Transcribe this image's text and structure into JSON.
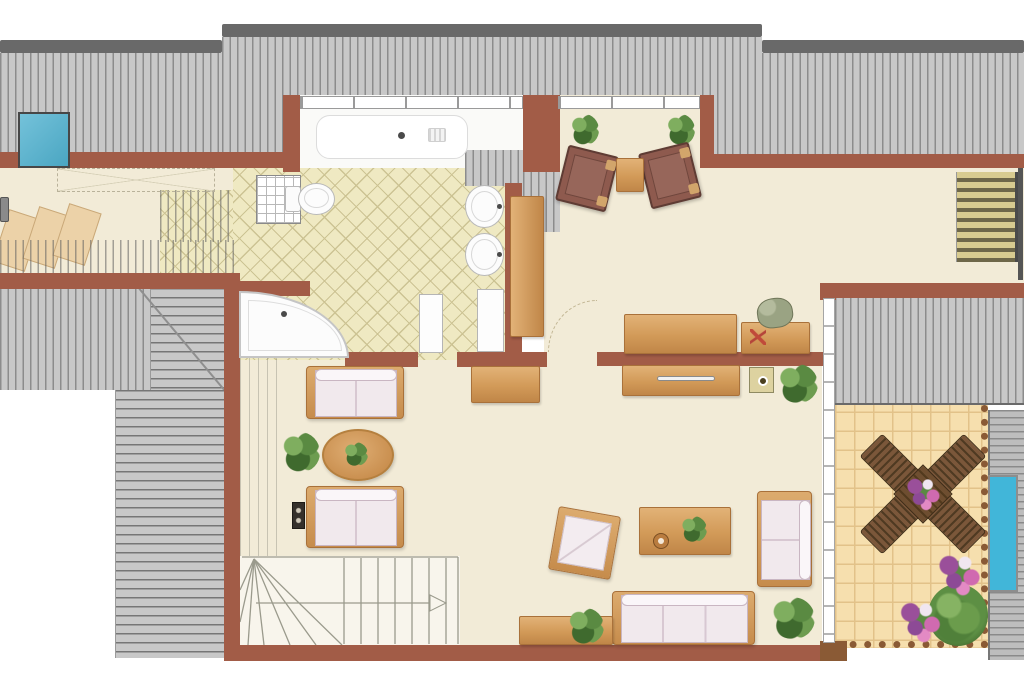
{
  "document": {
    "kind": "floor-plan",
    "floor": "attic",
    "canvas": {
      "width": 1024,
      "height": 683
    }
  },
  "palette": {
    "wall": "#a25c47",
    "fence": "#8a5a35",
    "floor": "#f2ebd7",
    "floor_white": "#fafaf8",
    "hatch_bg": "#c8c8c8",
    "hatch_line": "#8c8c8c",
    "cap": "#696969",
    "tile_bath": "#efe9c2",
    "tile_bath_line": "#ccc393",
    "tile_terrace": "#f6dfae",
    "tile_terrace_line": "#e2c289",
    "wood_hi": "#e2b277",
    "wood_lo": "#c08648",
    "wood_edge": "#a9713a",
    "sofa_fill": "#f1e9ed",
    "sofa_edge": "#c9b6c2",
    "chair_brown": "#8e5a4e",
    "chair_brown_edge": "#5f3c34",
    "pad": "#d2a56b",
    "plant_dark": "#3f6a2e",
    "plant_mid": "#5a8a42",
    "plant_light": "#7fae5f",
    "flower_purple": "#9a4f9a",
    "flower_pink": "#d06ab0",
    "sky_blue": "#4aa6c2",
    "pool_blue": "#41b6d9",
    "stripe_light": "#d8cb90",
    "stripe_dark": "#6e6749",
    "fixture": "#fcfcfc",
    "fixture_edge": "#c2c2c2",
    "stair_line": "#9a9a8c",
    "deck_bg": "#bdbdbd",
    "deck_line": "#8a8a8a",
    "arc": "#c2b694",
    "red_mark": "#c04a3a",
    "pig": "#9aa383",
    "pig_edge": "#6f7558",
    "dark": "#35302b"
  },
  "items": [
    {
      "name": "roof-cap-left",
      "type": "cap",
      "rect": [
        0,
        40,
        222,
        13
      ]
    },
    {
      "name": "roof-cap-middle",
      "type": "cap",
      "rect": [
        222,
        24,
        540,
        13
      ]
    },
    {
      "name": "roof-cap-right",
      "type": "cap",
      "rect": [
        762,
        40,
        262,
        13
      ]
    },
    {
      "name": "roof-slope-top-left",
      "type": "hatchv",
      "rect": [
        0,
        53,
        222,
        115
      ]
    },
    {
      "name": "roof-slope-top-middle",
      "type": "hatchv",
      "rect": [
        222,
        37,
        540,
        131
      ]
    },
    {
      "name": "roof-slope-top-right",
      "type": "hatchv",
      "rect": [
        762,
        53,
        262,
        101
      ]
    },
    {
      "name": "hallway-floor",
      "type": "floor",
      "rect": [
        0,
        168,
        160,
        105
      ]
    },
    {
      "name": "hallway-floor-sliver",
      "type": "floor",
      "rect": [
        160,
        168,
        123,
        24
      ]
    },
    {
      "name": "bathroom-dormer-floor",
      "type": "floorwhite",
      "rect": [
        300,
        95,
        223,
        77
      ]
    },
    {
      "name": "sitting-room-floor",
      "type": "floor",
      "rect": [
        558,
        95,
        144,
        75
      ]
    },
    {
      "name": "hall-floor",
      "type": "floor",
      "rect": [
        544,
        168,
        291,
        192
      ]
    },
    {
      "name": "corridor-floor",
      "type": "floor",
      "rect": [
        835,
        168,
        189,
        115
      ]
    },
    {
      "name": "living-room-floor",
      "type": "floor",
      "rect": [
        240,
        356,
        582,
        289
      ]
    },
    {
      "name": "bathroom-tiles",
      "type": "tilesbath",
      "rect": [
        233,
        168,
        289,
        192
      ]
    },
    {
      "name": "bathroom-tiles-strip",
      "type": "tilesbath",
      "rect": [
        160,
        190,
        73,
        83
      ]
    },
    {
      "name": "wood-step-1",
      "type": "stepwood",
      "rect": [
        0,
        213,
        34,
        55
      ],
      "rot": 18
    },
    {
      "name": "wood-step-2",
      "type": "stepwood",
      "rect": [
        30,
        210,
        34,
        55
      ],
      "rot": 18
    },
    {
      "name": "wood-step-3",
      "type": "stepwood",
      "rect": [
        60,
        207,
        34,
        55
      ],
      "rot": 18
    },
    {
      "name": "roof-overlay-hallway",
      "type": "vlines",
      "rect": [
        0,
        240,
        237,
        33
      ]
    },
    {
      "name": "roof-overlay-tiles",
      "type": "vlines",
      "rect": [
        160,
        190,
        73,
        52
      ]
    },
    {
      "name": "knee-wall-strip",
      "type": "vlineslight",
      "rect": [
        240,
        358,
        38,
        198
      ]
    },
    {
      "name": "roof-slope-left-mid",
      "type": "hatchv",
      "rect": [
        0,
        288,
        225,
        102
      ]
    },
    {
      "name": "roof-slope-left-hip",
      "type": "hatchh",
      "rect": [
        150,
        288,
        75,
        102
      ]
    },
    {
      "name": "roof-hip-line",
      "type": "hipline",
      "rect": [
        140,
        288,
        133,
        2
      ],
      "rot": 50
    },
    {
      "name": "roof-slope-bottom-left",
      "type": "hatchh",
      "rect": [
        115,
        390,
        110,
        268
      ]
    },
    {
      "name": "roof-patch-bath-ne",
      "type": "hatchv",
      "rect": [
        465,
        150,
        47,
        36
      ]
    },
    {
      "name": "roof-patch-wardrobe",
      "type": "hatchv",
      "rect": [
        510,
        150,
        50,
        46
      ]
    },
    {
      "name": "roof-patch-hall-west",
      "type": "hatchv",
      "rect": [
        523,
        170,
        37,
        62
      ]
    },
    {
      "name": "terrace-tiles",
      "type": "tilesterr",
      "rect": [
        835,
        405,
        153,
        243
      ]
    },
    {
      "name": "terrace-decking",
      "type": "deck",
      "rect": [
        988,
        410,
        36,
        250
      ]
    },
    {
      "name": "roof-slope-right-mid",
      "type": "hatchv edgeb",
      "rect": [
        835,
        298,
        189,
        107
      ]
    },
    {
      "name": "wall-hallway-north",
      "type": "wall",
      "rect": [
        0,
        152,
        300,
        16
      ]
    },
    {
      "name": "wall-bath-dormer-left",
      "type": "wall",
      "rect": [
        283,
        95,
        17,
        77
      ]
    },
    {
      "name": "wall-bath-sitting-divider",
      "type": "wall",
      "rect": [
        523,
        95,
        37,
        77
      ]
    },
    {
      "name": "wall-sitting-right",
      "type": "wall",
      "rect": [
        700,
        95,
        14,
        73
      ]
    },
    {
      "name": "wall-corridor-north",
      "type": "wall",
      "rect": [
        713,
        154,
        311,
        14
      ]
    },
    {
      "name": "wall-corridor-south",
      "type": "wall",
      "rect": [
        825,
        283,
        199,
        15
      ]
    },
    {
      "name": "wall-hallway-south",
      "type": "wall",
      "rect": [
        0,
        273,
        240,
        16
      ]
    },
    {
      "name": "wall-left-main",
      "type": "wall",
      "rect": [
        224,
        283,
        16,
        377
      ]
    },
    {
      "name": "wall-bath-nook",
      "type": "wall",
      "rect": [
        233,
        281,
        77,
        15
      ]
    },
    {
      "name": "wall-bath-south-west",
      "type": "wall",
      "rect": [
        345,
        352,
        73,
        15
      ]
    },
    {
      "name": "wall-bath-south-east",
      "type": "wall",
      "rect": [
        457,
        352,
        90,
        15
      ]
    },
    {
      "name": "wall-hall-south",
      "type": "wall",
      "rect": [
        597,
        352,
        233,
        14
      ]
    },
    {
      "name": "wall-bath-east",
      "type": "wall",
      "rect": [
        505,
        183,
        17,
        174
      ]
    },
    {
      "name": "wall-bottom",
      "type": "wall",
      "rect": [
        224,
        645,
        623,
        16
      ]
    },
    {
      "name": "wall-terrace-nw-post",
      "type": "wall",
      "rect": [
        820,
        283,
        16,
        17
      ]
    },
    {
      "name": "wall-terrace-sw-post",
      "type": "wallfence",
      "rect": [
        820,
        641,
        27,
        20
      ]
    },
    {
      "name": "bathroom-window",
      "type": "windowband",
      "rect": [
        300,
        96,
        223,
        13
      ]
    },
    {
      "name": "sitting-room-window",
      "type": "windowband",
      "rect": [
        558,
        96,
        142,
        13
      ]
    },
    {
      "name": "terrace-glass-wall",
      "type": "glassv",
      "rect": [
        823,
        298,
        12,
        345
      ]
    },
    {
      "name": "skylight",
      "type": "skylight",
      "rect": [
        18,
        112,
        52,
        56
      ]
    },
    {
      "name": "terrace-planter",
      "type": "planter",
      "rect": [
        988,
        475,
        30,
        117
      ]
    },
    {
      "name": "stairs-down",
      "type": "stripstairs",
      "rect": [
        956,
        172,
        62,
        90
      ]
    },
    {
      "name": "corridor-end-window",
      "type": "darkedge",
      "rect": [
        1018,
        168,
        5,
        112
      ]
    },
    {
      "name": "low-headroom-zone",
      "type": "dashrect",
      "rect": [
        57,
        168,
        158,
        24
      ]
    },
    {
      "name": "hallway-door-pull",
      "type": "graypull",
      "rect": [
        0,
        197,
        9,
        25
      ]
    },
    {
      "name": "bathtub",
      "type": "tub",
      "rect": [
        302,
        108,
        198,
        62
      ]
    },
    {
      "name": "shower",
      "type": "shower",
      "rect": [
        256,
        175,
        45,
        49
      ]
    },
    {
      "name": "toilet",
      "type": "toilet",
      "rect": [
        285,
        183,
        50,
        32
      ]
    },
    {
      "name": "washbasin-1",
      "type": "sink",
      "rect": [
        465,
        185,
        39,
        43
      ]
    },
    {
      "name": "washbasin-2",
      "type": "sink",
      "rect": [
        465,
        233,
        39,
        43
      ]
    },
    {
      "name": "bathroom-cabinet",
      "type": "cabinet",
      "rect": [
        477,
        289,
        27,
        63
      ]
    },
    {
      "name": "bathroom-door-leaf",
      "type": "cabinet",
      "rect": [
        419,
        294,
        24,
        59
      ]
    },
    {
      "name": "corner-bathtub",
      "type": "cornertub",
      "rect": [
        239,
        291,
        110,
        67
      ]
    },
    {
      "name": "wardrobe",
      "type": "woodv",
      "rect": [
        510,
        196,
        34,
        141
      ]
    },
    {
      "name": "hall-sideboard",
      "type": "wood",
      "rect": [
        624,
        314,
        113,
        40
      ]
    },
    {
      "name": "hall-desk",
      "type": "wood",
      "rect": [
        741,
        322,
        69,
        32
      ]
    },
    {
      "name": "piggy-bank",
      "type": "pig",
      "rect": [
        757,
        298,
        36,
        30
      ],
      "rot": -8
    },
    {
      "name": "desk-marks",
      "type": "marksred",
      "rect": [
        750,
        329,
        16,
        16
      ]
    },
    {
      "name": "tv-lowboard",
      "type": "wood",
      "rect": [
        622,
        365,
        118,
        31
      ]
    },
    {
      "name": "lowboard-handle",
      "type": "handle",
      "rect": [
        657,
        376,
        58,
        5
      ]
    },
    {
      "name": "wall-stool",
      "type": "stool",
      "rect": [
        749,
        367,
        25,
        26
      ]
    },
    {
      "name": "hall-plant",
      "type": "plant",
      "rect": [
        778,
        364,
        40,
        39
      ]
    },
    {
      "name": "hall-cabinet",
      "type": "wood",
      "rect": [
        471,
        366,
        69,
        37
      ]
    },
    {
      "name": "hall-door-arc",
      "type": "arcdoor",
      "rect": [
        548,
        300,
        49,
        52
      ]
    },
    {
      "name": "sitting-plant-left",
      "type": "plant",
      "rect": [
        571,
        114,
        28,
        31
      ]
    },
    {
      "name": "sitting-plant-right",
      "type": "plant",
      "rect": [
        667,
        114,
        28,
        31
      ]
    },
    {
      "name": "sitting-armchair-left",
      "type": "armb",
      "rect": [
        561,
        150,
        52,
        57
      ],
      "rot": 14
    },
    {
      "name": "sitting-armchair-right",
      "type": "armb",
      "rect": [
        644,
        147,
        52,
        57
      ],
      "rot": -14
    },
    {
      "name": "sitting-side-table",
      "type": "wood",
      "rect": [
        616,
        158,
        28,
        34
      ]
    },
    {
      "name": "sofa-north",
      "type": "sofa",
      "rect": [
        306,
        366,
        98,
        53
      ],
      "seams": 1
    },
    {
      "name": "sofa-south",
      "type": "sofa",
      "rect": [
        306,
        486,
        98,
        62
      ],
      "seams": 1
    },
    {
      "name": "coffee-table",
      "type": "oval",
      "rect": [
        322,
        429,
        72,
        52
      ]
    },
    {
      "name": "coffee-table-plant",
      "type": "plant",
      "rect": [
        344,
        442,
        24,
        24
      ]
    },
    {
      "name": "living-plant-west",
      "type": "plant",
      "rect": [
        282,
        432,
        38,
        40
      ]
    },
    {
      "name": "stereo-speaker",
      "type": "speaker",
      "rect": [
        292,
        502,
        13,
        27
      ]
    },
    {
      "name": "reading-armchair",
      "type": "armw",
      "rect": [
        553,
        511,
        63,
        64
      ],
      "rot": 10
    },
    {
      "name": "dining-table",
      "type": "wood",
      "rect": [
        639,
        507,
        92,
        48
      ]
    },
    {
      "name": "dining-table-plant",
      "type": "plant",
      "rect": [
        681,
        516,
        26,
        26
      ]
    },
    {
      "name": "dining-table-bowl",
      "type": "cup",
      "rect": [
        653,
        533,
        16,
        16
      ]
    },
    {
      "name": "sofa-east",
      "type": "sofav",
      "rect": [
        757,
        491,
        55,
        96
      ]
    },
    {
      "name": "sofa-wall",
      "type": "sofa",
      "rect": [
        612,
        591,
        143,
        54
      ],
      "seams": 2
    },
    {
      "name": "living-sideboard",
      "type": "wood",
      "rect": [
        519,
        616,
        94,
        29
      ]
    },
    {
      "name": "sideboard-plant",
      "type": "plant",
      "rect": [
        568,
        608,
        36,
        36
      ]
    },
    {
      "name": "living-plant-east",
      "type": "plant",
      "rect": [
        771,
        597,
        44,
        42
      ]
    },
    {
      "name": "staircase-main",
      "type": "stairsmain",
      "rect": [
        240,
        556,
        220,
        89
      ]
    },
    {
      "name": "terrace-dining-set",
      "type": "terracegrp",
      "rect": [
        861,
        444,
        124,
        100
      ]
    },
    {
      "name": "terrace-bush",
      "type": "bush",
      "rect": [
        928,
        584,
        60,
        62
      ]
    },
    {
      "name": "terrace-flowers-south",
      "type": "flowers",
      "rect": [
        896,
        598,
        48,
        48
      ]
    },
    {
      "name": "terrace-flowers-east",
      "type": "flowers",
      "rect": [
        934,
        551,
        50,
        48
      ]
    }
  ]
}
